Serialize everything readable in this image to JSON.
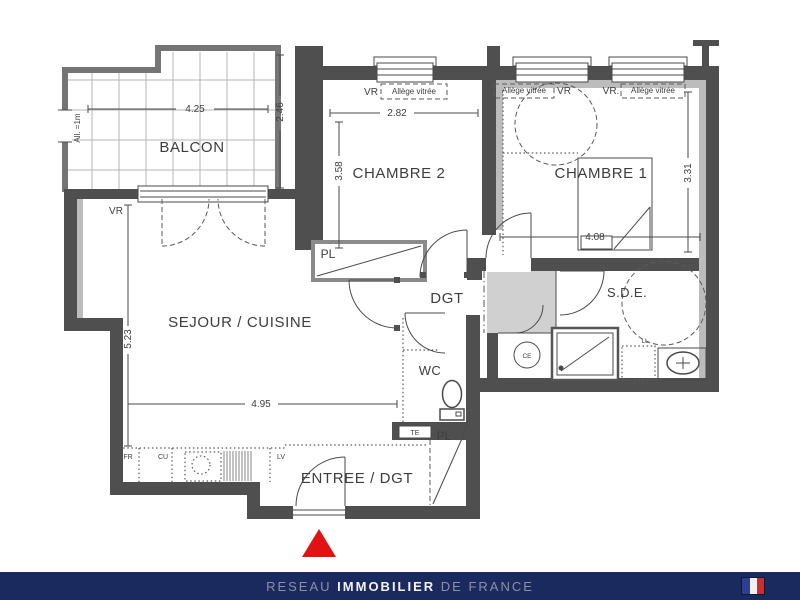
{
  "plan": {
    "rooms": {
      "balcon": "BALCON",
      "chambre2": "CHAMBRE 2",
      "chambre1": "CHAMBRE 1",
      "sejour_cuisine": "SEJOUR / CUISINE",
      "dgt": "DGT",
      "sde": "S.D.E.",
      "wc": "WC",
      "entree": "ENTREE / DGT"
    },
    "dimensions_m": {
      "balcon_width": "4.25",
      "balcon_depth": "2.46",
      "balcon_sill_height": "All. =1m",
      "chambre2_width": "2.82",
      "chambre2_depth": "3.58",
      "chambre1_width": "4.08",
      "chambre1_depth": "3.31",
      "sejour_width": "4.95",
      "sejour_depth": "5.23"
    },
    "annotations": {
      "vr": "VR",
      "vr_dot": "VR.",
      "allege_vitree": "Allège vitrée",
      "pl": "PL",
      "te": "TE",
      "ce": "CE",
      "ll": "LL",
      "fr": "FR",
      "cu": "CU",
      "lv": "LV"
    }
  },
  "footer": {
    "brand": {
      "prefix": "RESEAU",
      "main": "IMMOBILIER",
      "suffix": "DE FRANCE"
    }
  },
  "colors": {
    "wall_dark": "#4f4f4f",
    "duct_gray": "#d0d0d0",
    "footer_bar": "#1b2a5e",
    "footer_text_muted": "#8b90a6",
    "footer_text_highlight": "#f2f2f2",
    "entrance_marker_red": "#e31212",
    "flag_blue": "#2d3f92",
    "flag_white": "#f0f0f0",
    "flag_red": "#d22b2b"
  }
}
